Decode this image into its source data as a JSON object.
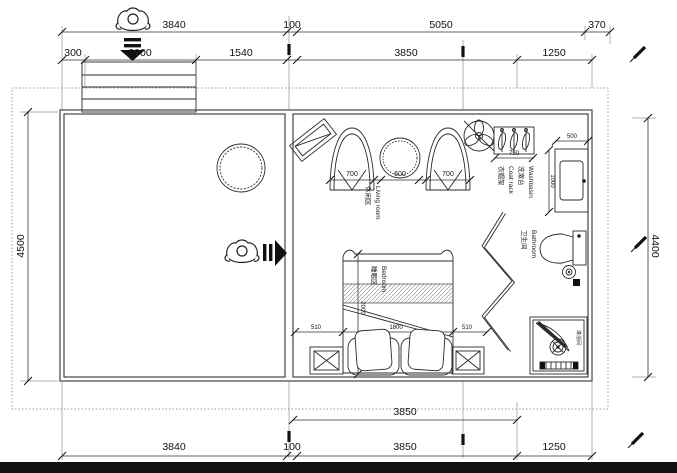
{
  "dims": {
    "top1": [
      "3840",
      "100",
      "5050",
      "370"
    ],
    "top2": [
      "300",
      "2000",
      "1540",
      "3850",
      "1250"
    ],
    "bottom1": [
      "3850"
    ],
    "bottom2": [
      "3840",
      "100",
      "3850",
      "1250"
    ],
    "left_height": "4500",
    "right_height": "4400",
    "seat_left": "700",
    "table": "600",
    "seat_right": "700",
    "coat_rack": "750",
    "basin_width": "500",
    "basin_depth": "1000",
    "bed_length": "2000",
    "bed_width": "1800",
    "nightstand_left": "510",
    "nightstand_right": "510"
  },
  "labels": {
    "living_zh": "休闲区",
    "living_en": "Living room",
    "coat_zh": "衣帽架",
    "coat_en": "Coat rack",
    "basin_zh": "洗漱台",
    "basin_en": "Washbasin",
    "bath_zh": "卫生间",
    "bath_en": "Bathroom",
    "bed_zh": "睡眠区",
    "bed_en": "Bedroom",
    "shower_zh": "淋浴间"
  }
}
